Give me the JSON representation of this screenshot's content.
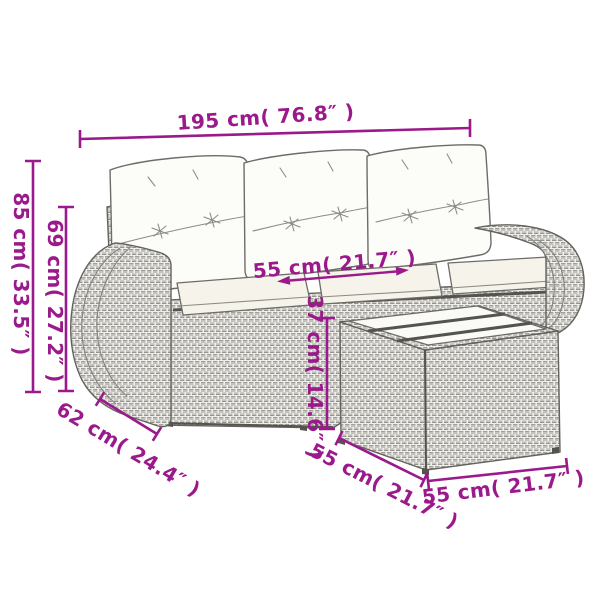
{
  "style": {
    "background": "#ffffff",
    "accent_color": "#9B1A8B",
    "line_color": "#64625d"
  },
  "labels": {
    "sofa_width": "195 cm( 76.8″ )",
    "sofa_height": "85 cm( 33.5″ )",
    "backrest_height": "69 cm( 27.2″ )",
    "seat_depth": "55 cm( 21.7″ )",
    "seat_height": "37 cm( 14.6″ )",
    "armrest_width": "62 cm( 24.4″ )",
    "table_depth": "55 cm( 21.7″ )",
    "table_width": "55 cm( 21.7″ )"
  }
}
